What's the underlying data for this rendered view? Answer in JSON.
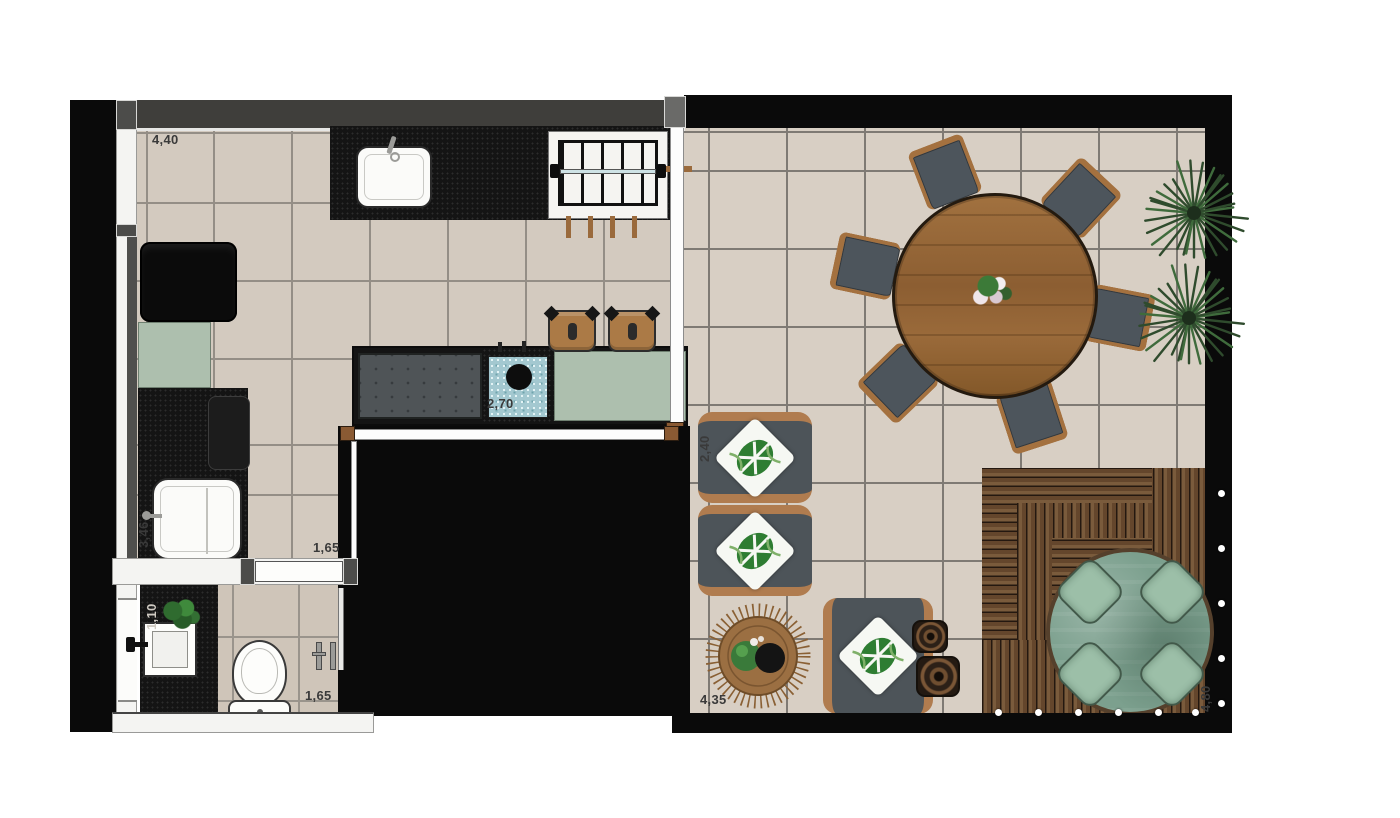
{
  "plan": {
    "type": "apartment-floor-plan-top-view",
    "dimensions": [
      {
        "text": "4,40",
        "orientation": "horizontal",
        "location": "kitchen-top-left"
      },
      {
        "text": "2,70",
        "orientation": "horizontal",
        "location": "island-sink"
      },
      {
        "text": "1,65",
        "orientation": "horizontal",
        "location": "hall-passage"
      },
      {
        "text": "3,46",
        "orientation": "vertical",
        "location": "kitchen-left-wall"
      },
      {
        "text": "1,10",
        "orientation": "vertical",
        "location": "bathroom-counter"
      },
      {
        "text": "1,65",
        "orientation": "horizontal",
        "location": "bathroom"
      },
      {
        "text": "2,40",
        "orientation": "vertical",
        "location": "lounge-chairs"
      },
      {
        "text": "4,35",
        "orientation": "horizontal",
        "location": "terrace-bottom-left"
      },
      {
        "text": "4,80",
        "orientation": "vertical",
        "location": "deck-right-edge"
      }
    ],
    "rooms": [
      "kitchen",
      "bathroom",
      "hall-passage",
      "terrace-living",
      "wood-deck"
    ],
    "furniture_counts": {
      "dining_chairs": 6,
      "bar_stools": 2,
      "lounge_chairs": 3,
      "side_tables": 2,
      "hot_tub_seats": 4,
      "palm_plants": 2
    },
    "colors": {
      "floor_tile": "#d3cabf",
      "living_tile": "#d8cfc4",
      "bath_tile": "#cfc5b9",
      "grout": "#8a847d",
      "wall_black": "#0a0a0a",
      "counter_granite": "#141414",
      "sage_cabinet": "#adbfae",
      "wood_furniture": "#a4713f",
      "seat_gray": "#4d555c",
      "deck_wood": "#6b4e35",
      "tub_water": "#7ca08e",
      "pillow_leaf_green": "#2e7d32"
    }
  }
}
